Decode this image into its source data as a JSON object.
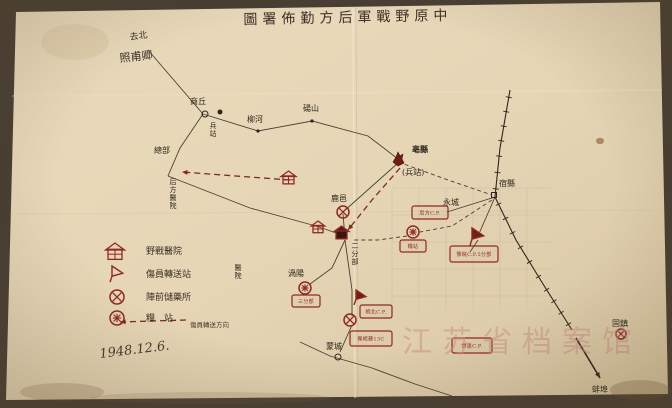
{
  "document": {
    "type": "hand-drawn military logistics map, archival photograph",
    "date": "1948.12.6.",
    "watermark": "江苏省档案馆",
    "colors": {
      "paper": "#e7d7b8",
      "photo_bg": "#473e33",
      "red_ink": "#8e2920",
      "black_ink": "#2d261d",
      "watermark_pink": "#c98f82"
    }
  },
  "title": {
    "display": "圖署佈勤方后軍戰野原中",
    "reading_direction": "right-to-left",
    "rtl_reading": "中原野戰軍后方勤佈署圖"
  },
  "corner_note": {
    "line1": "去北",
    "line2": "照甫卿"
  },
  "date": "1948.12.6.",
  "watermark": "江苏省档案馆",
  "legend": {
    "items": [
      {
        "symbol": "field-hospital",
        "label": "野戰醫院"
      },
      {
        "symbol": "casualty-transfer-station",
        "label": "傷員轉送站"
      },
      {
        "symbol": "forward-medicine-depot",
        "label": "陣前儲藥所"
      },
      {
        "symbol": "grain-station",
        "label": "糧　站"
      },
      {
        "symbol": "wounded-transfer-route",
        "label": "傷員轉送方向"
      }
    ]
  },
  "map": {
    "grid": {
      "x0": 392,
      "y0": 188,
      "w": 160,
      "h": 122,
      "step": 27
    },
    "roads": [
      {
        "style": "solid",
        "points": [
          [
            148,
            50
          ],
          [
            203,
            114
          ]
        ]
      },
      {
        "style": "solid",
        "points": [
          [
            203,
            114
          ],
          [
            258,
            131
          ],
          [
            312,
            121
          ],
          [
            368,
            136
          ],
          [
            398,
            159
          ]
        ]
      },
      {
        "style": "solid",
        "points": [
          [
            203,
            114
          ],
          [
            180,
            148
          ],
          [
            168,
            176
          ]
        ]
      },
      {
        "style": "solid",
        "points": [
          [
            168,
            176
          ],
          [
            250,
            208
          ],
          [
            316,
            226
          ]
        ]
      },
      {
        "style": "solid",
        "points": [
          [
            316,
            226
          ],
          [
            345,
            236
          ]
        ]
      },
      {
        "style": "dashed",
        "points": [
          [
            398,
            162
          ],
          [
            448,
            180
          ],
          [
            492,
            195
          ]
        ]
      },
      {
        "style": "solid",
        "points": [
          [
            495,
            197
          ],
          [
            478,
            236
          ]
        ]
      },
      {
        "style": "solid",
        "points": [
          [
            495,
            197
          ],
          [
            447,
            212
          ]
        ]
      },
      {
        "style": "dashed",
        "points": [
          [
            492,
            200
          ],
          [
            452,
            226
          ],
          [
            420,
            232
          ]
        ]
      },
      {
        "style": "dashed",
        "points": [
          [
            407,
            236
          ],
          [
            378,
            240
          ],
          [
            352,
            240
          ]
        ]
      },
      {
        "style": "solid",
        "points": [
          [
            345,
            238
          ],
          [
            343,
            214
          ]
        ]
      },
      {
        "style": "solid",
        "points": [
          [
            343,
            212
          ],
          [
            398,
            163
          ]
        ]
      },
      {
        "style": "solid",
        "points": [
          [
            345,
            240
          ],
          [
            332,
            268
          ],
          [
            310,
            284
          ]
        ]
      },
      {
        "style": "solid",
        "points": [
          [
            345,
            240
          ],
          [
            352,
            290
          ],
          [
            352,
            316
          ]
        ]
      },
      {
        "style": "solid",
        "points": [
          [
            352,
            325
          ],
          [
            340,
            352
          ]
        ]
      },
      {
        "style": "solid",
        "points": [
          [
            300,
            342
          ],
          [
            330,
            356
          ],
          [
            372,
            368
          ],
          [
            415,
            384
          ],
          [
            452,
            396
          ]
        ]
      },
      {
        "style": "solid",
        "points": [
          [
            478,
            240
          ],
          [
            470,
            252
          ]
        ]
      }
    ],
    "railways": [
      {
        "points": [
          [
            510,
            90
          ],
          [
            500,
            148
          ],
          [
            495,
            197
          ]
        ]
      },
      {
        "points": [
          [
            495,
            197
          ],
          [
            516,
            240
          ],
          [
            543,
            284
          ],
          [
            572,
            330
          ]
        ]
      }
    ],
    "arrows_black": [
      {
        "points": [
          [
            576,
            338
          ],
          [
            600,
            378
          ]
        ]
      }
    ],
    "red_routes": [
      {
        "points": [
          [
            290,
            180
          ],
          [
            182,
            172
          ]
        ]
      },
      {
        "points": [
          [
            400,
            168
          ],
          [
            372,
            200
          ],
          [
            348,
            230
          ]
        ]
      },
      {
        "points": [
          [
            186,
            320
          ],
          [
            120,
            322
          ]
        ],
        "legend": true
      }
    ],
    "symbols": [
      {
        "type": "house",
        "x": 108,
        "y": 243,
        "s": 14
      },
      {
        "type": "flag",
        "x": 112,
        "y": 266,
        "s": 12
      },
      {
        "type": "circle-x",
        "x": 117,
        "y": 297,
        "r": 7
      },
      {
        "type": "circle-m",
        "x": 117,
        "y": 318,
        "r": 7
      },
      {
        "type": "house",
        "x": 283,
        "y": 171,
        "s": 11
      },
      {
        "type": "house",
        "x": 313,
        "y": 221,
        "s": 10
      },
      {
        "type": "house",
        "x": 336,
        "y": 226,
        "s": 11,
        "filled": true
      },
      {
        "type": "flame",
        "x": 398,
        "y": 160
      },
      {
        "type": "flag",
        "x": 472,
        "y": 228,
        "s": 13,
        "filled": true
      },
      {
        "type": "flag",
        "x": 356,
        "y": 290,
        "s": 11,
        "filled": true
      },
      {
        "type": "circle-x",
        "x": 343,
        "y": 212,
        "r": 6
      },
      {
        "type": "circle-x",
        "x": 350,
        "y": 320,
        "r": 6
      },
      {
        "type": "circle-x",
        "x": 621,
        "y": 334,
        "r": 5
      },
      {
        "type": "circle-m",
        "x": 413,
        "y": 232,
        "r": 6
      },
      {
        "type": "circle-m",
        "x": 305,
        "y": 288,
        "r": 6
      },
      {
        "type": "dot",
        "x": 220,
        "y": 112,
        "r": 2.5
      }
    ],
    "boxes": [
      {
        "text": "后方C.P.",
        "x": 412,
        "y": 206,
        "w": 36,
        "h": 13
      },
      {
        "text": "糧站",
        "x": 400,
        "y": 240,
        "w": 26,
        "h": 12
      },
      {
        "text": "豫皖C.P.5分部",
        "x": 450,
        "y": 246,
        "w": 48,
        "h": 16
      },
      {
        "text": "三分部",
        "x": 292,
        "y": 295,
        "w": 28,
        "h": 12
      },
      {
        "text": "皖北C.P.",
        "x": 360,
        "y": 305,
        "w": 32,
        "h": 13
      },
      {
        "text": "豫皖蘇13C",
        "x": 350,
        "y": 331,
        "w": 42,
        "h": 15
      },
      {
        "text": "懷遠C.P.",
        "x": 452,
        "y": 338,
        "w": 40,
        "h": 15
      }
    ],
    "places": [
      {
        "name": "商丘",
        "x": 190,
        "y": 104,
        "marker": "circle",
        "mx": 205,
        "my": 114
      },
      {
        "name": "柳河",
        "x": 247,
        "y": 122,
        "marker": "dot",
        "mx": 258,
        "my": 131
      },
      {
        "name": "碭山",
        "x": 303,
        "y": 111,
        "marker": "dot",
        "mx": 312,
        "my": 121
      },
      {
        "name": "亳縣",
        "x": 412,
        "y": 152,
        "bold": true
      },
      {
        "name": "(兵站)",
        "x": 402,
        "y": 175,
        "small": true
      },
      {
        "name": "宿縣",
        "x": 499,
        "y": 186,
        "marker": "square",
        "mx": 494,
        "my": 195
      },
      {
        "name": "永城",
        "x": 443,
        "y": 205
      },
      {
        "name": "鹿邑",
        "x": 331,
        "y": 201
      },
      {
        "name": "渦陽",
        "x": 288,
        "y": 276
      },
      {
        "name": "蒙城",
        "x": 326,
        "y": 349,
        "marker": "circle",
        "mx": 338,
        "my": 357
      },
      {
        "name": "固鎮",
        "x": 612,
        "y": 326
      },
      {
        "name": "蚌埠",
        "x": 592,
        "y": 392
      },
      {
        "name": "總部",
        "x": 154,
        "y": 153
      }
    ],
    "vertical_labels": [
      {
        "text": "后方醫院",
        "x": 173,
        "y": 184
      },
      {
        "text": "兵站",
        "x": 213,
        "y": 128
      },
      {
        "text": "醫院",
        "x": 238,
        "y": 270
      },
      {
        "text": "二分部",
        "x": 355,
        "y": 248
      }
    ]
  }
}
